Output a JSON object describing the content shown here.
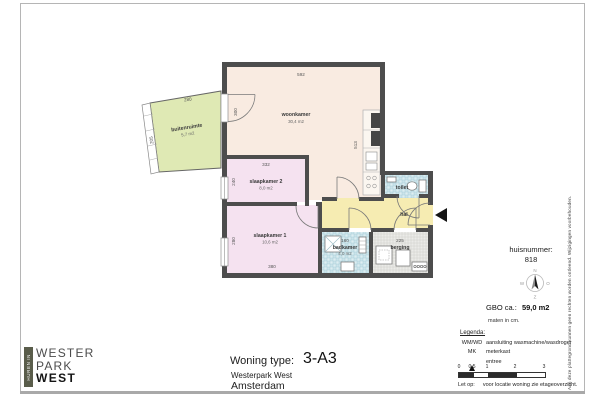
{
  "sheet": {
    "disclaimer_vertical": "Aan deze plattegrond kunnen geen rechten worden ontleend. Wijzigingen voorbehouden."
  },
  "logo": {
    "vertical_tagline": "HUREN IN",
    "line1": "WESTER",
    "line2": "PARK",
    "line3": "WEST"
  },
  "title_block": {
    "label": "Woning type:",
    "woning_type": "3-A3",
    "project": "Westerpark West",
    "city": "Amsterdam"
  },
  "info_panel": {
    "huisnummer_label": "huisnummer:",
    "huisnummer": "818",
    "compass": {
      "north": "N",
      "east": "O",
      "south": "Z",
      "west": "W"
    },
    "gbo_label": "GBO ca.:",
    "gbo_value": "59,0 m2",
    "units_note": "maten in cm.",
    "legend_title": "Legenda:",
    "legend": [
      {
        "key": "WM/WD",
        "desc": "aansluiting wasmachine/wasdroger"
      },
      {
        "key": "MK",
        "desc": "meterkast"
      },
      {
        "key": "entree-icon",
        "desc": "entree"
      }
    ],
    "scale_ticks": [
      "0",
      "0,5",
      "1",
      "2",
      "3"
    ],
    "note_label": "Let op:",
    "note_text": "voor locatie woning zie etageoverzicht."
  },
  "plan": {
    "rooms": {
      "woonkamer": {
        "name": "woonkamer",
        "area": "30,4 m2"
      },
      "slaapkamer1": {
        "name": "slaapkamer 1",
        "area": "10,6 m2"
      },
      "slaapkamer2": {
        "name": "slaapkamer 2",
        "area": "8,0 m2"
      },
      "buitenruimte": {
        "name": "buitenruimte",
        "area": "5,7 m2"
      },
      "badkamer": {
        "name": "badkamer",
        "area": "4,0 m2"
      },
      "toilet": {
        "name": "toilet"
      },
      "hal": {
        "name": "hal"
      },
      "berging": {
        "name": "berging"
      }
    },
    "dimensions": {
      "woonkamer_breedte": "592",
      "woonkamer_diepte": "513",
      "slaapkamer2_breedte": "332",
      "slaapkamer2_diepte": "240",
      "slaapkamer1_breedte": "380",
      "slaapkamer1_diepte": "280",
      "buitenruimte_breedte": "280",
      "buitenruimte_diepte": "205",
      "badkamer_breedte": "160",
      "berging_breedte": "225",
      "balkondeur": "300"
    },
    "colors": {
      "woonkamer": "#f9ebe1",
      "slaapkamer": "#f5e2f0",
      "hal": "#f6ecb2",
      "sanitair": "#ddeef1",
      "berging": "#ebebe8",
      "buitenruimte": "#dfe9b4",
      "wall": "#4d4d4d"
    }
  }
}
